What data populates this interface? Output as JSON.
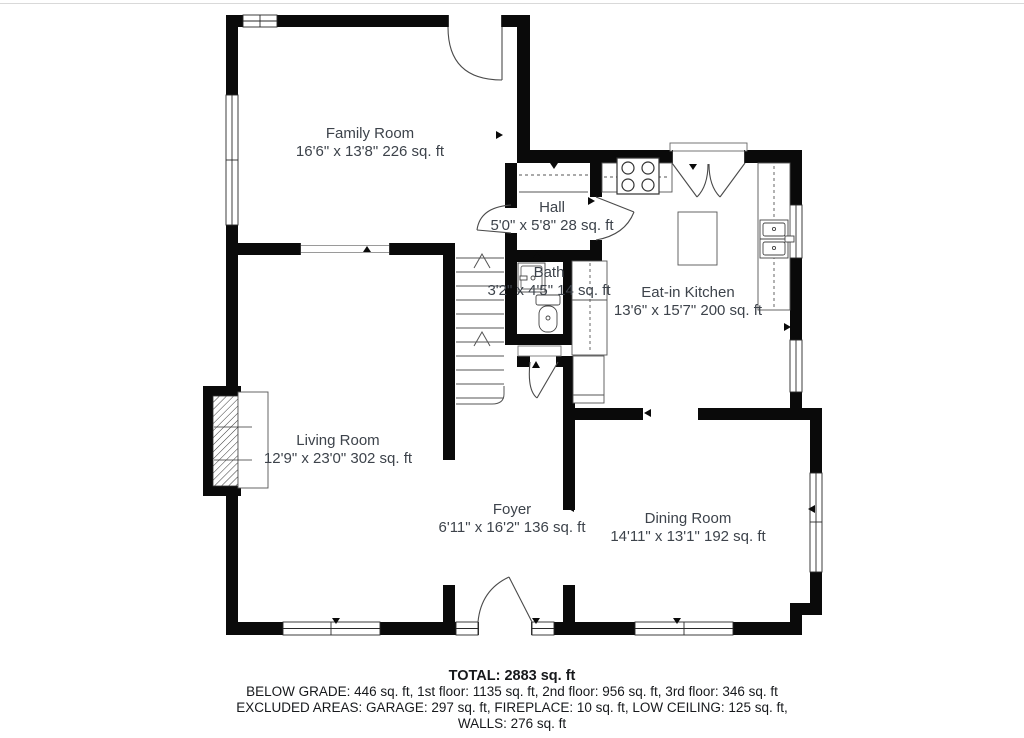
{
  "title": "First floor plan",
  "colors": {
    "wall": "#0a0a0a",
    "thin_line": "#4a4a4a",
    "room_text": "#3d434b",
    "footer_text": "#17191c",
    "divider": "#d9d9d9"
  },
  "rooms": [
    {
      "name": "Family Room",
      "dims": "16'6\" x 13'8\" 226 sq. ft"
    },
    {
      "name": "Hall",
      "dims": "5'0\" x 5'8\" 28 sq. ft"
    },
    {
      "name": "Bath",
      "dims": "3'2\" x 4'5\" 14 sq. ft"
    },
    {
      "name": "Eat-in Kitchen",
      "dims": "13'6\" x 15'7\" 200 sq. ft"
    },
    {
      "name": "Living Room",
      "dims": "12'9\" x 23'0\" 302 sq. ft"
    },
    {
      "name": "Foyer",
      "dims": "6'11\" x 16'2\" 136 sq. ft"
    },
    {
      "name": "Dining Room",
      "dims": "14'11\" x 13'1\" 192 sq. ft"
    }
  ],
  "fixtures": [
    "stove-icon",
    "kitchen-sink-icon",
    "kitchen-island",
    "refrigerator",
    "bathroom-sink-icon",
    "toilet-icon",
    "fireplace-icon",
    "staircase",
    "door-swing-arcs",
    "window-glyphs"
  ],
  "footer": {
    "total": "TOTAL: 2883 sq. ft",
    "below_grade": "BELOW GRADE: 446 sq. ft, 1st floor: 1135 sq. ft, 2nd floor: 956 sq. ft, 3rd floor: 346 sq. ft",
    "excluded": "EXCLUDED AREAS: GARAGE: 297 sq. ft, FIREPLACE: 10 sq. ft, LOW CEILING: 125 sq. ft,",
    "walls": "WALLS: 276 sq. ft"
  }
}
